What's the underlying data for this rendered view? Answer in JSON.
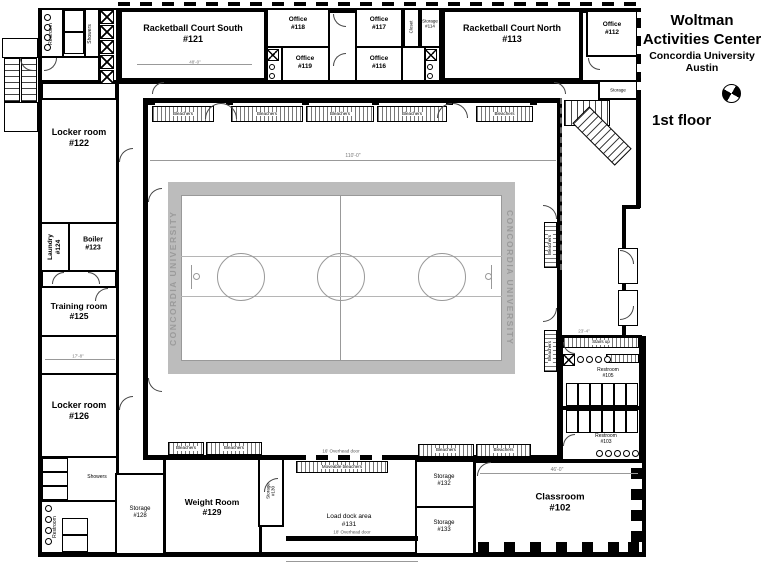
{
  "header": {
    "line1": "Woltman",
    "line2": "Activities Center",
    "line3": "Concordia University",
    "line4": "Austin",
    "floor": "1st floor"
  },
  "plan": {
    "walls": [
      [
        38,
        8,
        5,
        549
      ],
      [
        118,
        8,
        522,
        5
      ],
      [
        38,
        552,
        608,
        5
      ],
      [
        636,
        8,
        5,
        200
      ],
      [
        622,
        205,
        18,
        4
      ],
      [
        622,
        205,
        4,
        135
      ],
      [
        622,
        336,
        24,
        4
      ],
      [
        641,
        340,
        5,
        215
      ],
      [
        40,
        80,
        598,
        4
      ],
      [
        115,
        80,
        4,
        477
      ]
    ],
    "iwalls": [
      [
        62,
        8,
        2,
        50
      ],
      [
        84,
        8,
        2,
        50
      ],
      [
        98,
        8,
        2,
        74
      ],
      [
        40,
        56,
        60,
        2
      ],
      [
        560,
        406,
        82,
        4
      ],
      [
        286,
        536,
        132,
        5
      ]
    ],
    "rooms": [
      {
        "n": "entrance-canopy",
        "x": 2,
        "y": 38,
        "w": 36,
        "h": 20,
        "t": 1
      },
      {
        "n": "entry-landing",
        "x": 4,
        "y": 102,
        "w": 34,
        "h": 30,
        "t": 1
      },
      {
        "n": "utility-block-nw",
        "x": 40,
        "y": 8,
        "w": 78,
        "h": 74,
        "t": 2
      },
      {
        "n": "racketball-court-south-121",
        "x": 118,
        "y": 8,
        "w": 150,
        "h": 74,
        "t": 4
      },
      {
        "n": "office-118",
        "x": 266,
        "y": 8,
        "w": 64,
        "h": 40,
        "t": 2
      },
      {
        "n": "restroom-off-119",
        "x": 266,
        "y": 46,
        "w": 17,
        "h": 36,
        "t": 2
      },
      {
        "n": "office-119",
        "x": 281,
        "y": 46,
        "w": 49,
        "h": 36,
        "t": 2
      },
      {
        "n": "office-117",
        "x": 355,
        "y": 8,
        "w": 48,
        "h": 40,
        "t": 2
      },
      {
        "n": "office-116",
        "x": 355,
        "y": 46,
        "w": 48,
        "h": 36,
        "t": 2
      },
      {
        "n": "closet",
        "x": 403,
        "y": 8,
        "w": 17,
        "h": 40,
        "t": 2
      },
      {
        "n": "storage-114",
        "x": 420,
        "y": 8,
        "w": 21,
        "h": 40,
        "t": 2
      },
      {
        "n": "janitor-closet",
        "x": 424,
        "y": 46,
        "w": 17,
        "h": 36,
        "t": 2
      },
      {
        "n": "racketball-court-north-113",
        "x": 441,
        "y": 8,
        "w": 142,
        "h": 74,
        "t": 4
      },
      {
        "n": "office-112",
        "x": 586,
        "y": 10,
        "w": 52,
        "h": 47,
        "t": 2
      },
      {
        "n": "storage-ne",
        "x": 598,
        "y": 80,
        "w": 40,
        "h": 20,
        "t": 2
      },
      {
        "n": "locker-room-122",
        "x": 40,
        "y": 98,
        "w": 78,
        "h": 126,
        "t": 2
      },
      {
        "n": "laundry-124",
        "x": 40,
        "y": 222,
        "w": 30,
        "h": 50,
        "t": 2
      },
      {
        "n": "boiler-123",
        "x": 68,
        "y": 222,
        "w": 50,
        "h": 50,
        "t": 2
      },
      {
        "n": "training-room-125",
        "x": 40,
        "y": 286,
        "w": 78,
        "h": 51,
        "t": 2
      },
      {
        "n": "room-sw",
        "x": 40,
        "y": 335,
        "w": 78,
        "h": 40,
        "t": 2
      },
      {
        "n": "locker-room-126",
        "x": 40,
        "y": 373,
        "w": 78,
        "h": 85,
        "t": 2
      },
      {
        "n": "showers-sw",
        "x": 40,
        "y": 456,
        "w": 78,
        "h": 46,
        "t": 2
      },
      {
        "n": "restroom-sw",
        "x": 40,
        "y": 500,
        "w": 78,
        "h": 54,
        "t": 2
      },
      {
        "n": "storage-128",
        "x": 115,
        "y": 473,
        "w": 50,
        "h": 82,
        "t": 2
      },
      {
        "n": "weight-room-129",
        "x": 163,
        "y": 455,
        "w": 99,
        "h": 100,
        "t": 3
      },
      {
        "n": "storage-130",
        "x": 258,
        "y": 455,
        "w": 26,
        "h": 72,
        "t": 2
      },
      {
        "n": "storage-132",
        "x": 415,
        "y": 460,
        "w": 60,
        "h": 48,
        "t": 2
      },
      {
        "n": "storage-133",
        "x": 415,
        "y": 506,
        "w": 60,
        "h": 49,
        "t": 2
      },
      {
        "n": "classroom-102",
        "x": 473,
        "y": 460,
        "w": 172,
        "h": 95,
        "t": 3
      },
      {
        "n": "restroom-block-e",
        "x": 560,
        "y": 335,
        "w": 82,
        "h": 127,
        "t": 3
      },
      {
        "n": "entry-alcove-1",
        "x": 618,
        "y": 248,
        "w": 20,
        "h": 36,
        "t": 1
      },
      {
        "n": "entry-alcove-2",
        "x": 618,
        "y": 290,
        "w": 20,
        "h": 36,
        "t": 1
      },
      {
        "n": "gymnasium",
        "x": 143,
        "y": 98,
        "w": 419,
        "h": 362,
        "t": 5
      }
    ],
    "dashes": [
      [
        118,
        2,
        522,
        4,
        "h"
      ],
      [
        637,
        12,
        4,
        88,
        "v"
      ],
      [
        294,
        455,
        96,
        5,
        "h"
      ]
    ],
    "dots": [
      [
        560,
        98,
        2,
        172
      ]
    ],
    "hatches": [
      {
        "x": 152,
        "y": 106,
        "w": 62,
        "h": 16,
        "label": "Bleachers"
      },
      {
        "x": 231,
        "y": 106,
        "w": 72,
        "h": 16,
        "label": "Bleachers"
      },
      {
        "x": 306,
        "y": 106,
        "w": 68,
        "h": 16,
        "label": "Bleachers"
      },
      {
        "x": 377,
        "y": 106,
        "w": 70,
        "h": 16,
        "label": "Bleachers"
      },
      {
        "x": 476,
        "y": 106,
        "w": 57,
        "h": 16,
        "label": "Bleachers"
      },
      {
        "x": 168,
        "y": 442,
        "w": 36,
        "h": 13,
        "label": "Bleachers"
      },
      {
        "x": 206,
        "y": 442,
        "w": 56,
        "h": 13,
        "label": "Bleachers"
      },
      {
        "x": 418,
        "y": 444,
        "w": 56,
        "h": 13,
        "label": "Bleachers"
      },
      {
        "x": 476,
        "y": 444,
        "w": 55,
        "h": 13,
        "label": "Bleachers"
      },
      {
        "x": 544,
        "y": 222,
        "w": 13,
        "h": 46,
        "v": 1,
        "label": "Bleachers"
      },
      {
        "x": 544,
        "y": 330,
        "w": 13,
        "h": 42,
        "v": 1,
        "label": "Bleachers"
      },
      {
        "x": 296,
        "y": 461,
        "w": 92,
        "h": 12,
        "label": "Moveable bleachers"
      },
      {
        "x": 563,
        "y": 337,
        "w": 76,
        "h": 11,
        "label": "Stairs up"
      },
      {
        "x": 606,
        "y": 354,
        "w": 33,
        "h": 9
      }
    ],
    "stairs": [
      {
        "x": 4,
        "y": 58,
        "w": 16,
        "h": 44,
        "d": "v"
      },
      {
        "x": 21,
        "y": 58,
        "w": 16,
        "h": 44,
        "d": "v"
      },
      {
        "x": 564,
        "y": 100,
        "w": 46,
        "h": 26,
        "d": "h"
      },
      {
        "x": 572,
        "y": 124,
        "w": 60,
        "h": 24,
        "d": "h",
        "rot": 45
      }
    ],
    "court": {
      "frame": [
        168,
        182,
        347,
        192
      ],
      "inner": [
        181,
        195,
        321,
        166
      ],
      "center_x": 340,
      "lane_y": [
        256,
        296
      ],
      "circles_cx": [
        241,
        341,
        442
      ],
      "circle_cy": 277,
      "circle_r": 24,
      "brand": "CONCORDIA UNIVERSITY",
      "baskets": [
        {
          "line": [
            191,
            265,
            1,
            24
          ],
          "circ": [
            193,
            273,
            7
          ]
        },
        {
          "line": [
            491,
            265,
            1,
            24
          ],
          "circ": [
            485,
            273,
            7
          ]
        }
      ]
    },
    "cellrows": [
      {
        "x": 64,
        "y": 10,
        "w": 20,
        "h": 44,
        "n": 2,
        "d": "v"
      },
      {
        "x": 42,
        "y": 458,
        "w": 26,
        "h": 42,
        "n": 3,
        "d": "v"
      },
      {
        "x": 62,
        "y": 518,
        "w": 26,
        "h": 34,
        "n": 2,
        "d": "v"
      },
      {
        "x": 566,
        "y": 383,
        "w": 72,
        "h": 23,
        "n": 6,
        "d": "h"
      },
      {
        "x": 566,
        "y": 410,
        "w": 72,
        "h": 23,
        "n": 6,
        "d": "h"
      }
    ],
    "xboxes": [
      [
        100,
        10,
        14
      ],
      [
        100,
        25,
        14
      ],
      [
        100,
        40,
        14
      ],
      [
        100,
        55,
        14
      ],
      [
        100,
        70,
        14
      ],
      [
        267,
        49,
        12
      ],
      [
        425,
        49,
        12
      ],
      [
        563,
        354,
        12
      ]
    ],
    "sinks": [
      {
        "x": 44,
        "y": 14,
        "n": 4,
        "sx": 0,
        "sy": 10,
        "d": 7
      },
      {
        "x": 45,
        "y": 505,
        "n": 4,
        "sx": 0,
        "sy": 11,
        "d": 7
      },
      {
        "x": 577,
        "y": 356,
        "n": 4,
        "sx": 9,
        "sy": 0,
        "d": 7
      },
      {
        "x": 596,
        "y": 450,
        "n": 5,
        "sx": 9,
        "sy": 0,
        "d": 7
      },
      {
        "x": 269,
        "y": 64,
        "n": 2,
        "sx": 0,
        "sy": 9,
        "d": 6
      },
      {
        "x": 427,
        "y": 64,
        "n": 2,
        "sx": 0,
        "sy": 9,
        "d": 6
      }
    ],
    "squares": [
      [
        148,
        98,
        7
      ],
      [
        226,
        98,
        7
      ],
      [
        302,
        98,
        7
      ],
      [
        372,
        98,
        7
      ],
      [
        446,
        98,
        7
      ],
      [
        530,
        98,
        7
      ],
      [
        478,
        542,
        11
      ],
      [
        504,
        542,
        11
      ],
      [
        530,
        542,
        11
      ],
      [
        556,
        542,
        11
      ],
      [
        582,
        542,
        11
      ],
      [
        608,
        542,
        11
      ],
      [
        628,
        542,
        11
      ],
      [
        631,
        468,
        11
      ],
      [
        631,
        489,
        11
      ],
      [
        631,
        510,
        11
      ],
      [
        631,
        531,
        11
      ]
    ],
    "dims": [
      [
        150,
        160,
        406
      ],
      [
        480,
        473,
        158
      ],
      [
        45,
        359,
        70
      ],
      [
        137,
        64,
        115
      ],
      [
        286,
        561,
        132
      ]
    ],
    "doors": [
      [
        205,
        103,
        16,
        "tl"
      ],
      [
        221,
        103,
        16,
        "tr"
      ],
      [
        437,
        103,
        15,
        "tl"
      ],
      [
        453,
        103,
        15,
        "tr"
      ],
      [
        148,
        188,
        14,
        "tl"
      ],
      [
        148,
        378,
        14,
        "bl"
      ],
      [
        543,
        205,
        14,
        "tr"
      ],
      [
        543,
        308,
        14,
        "br"
      ],
      [
        333,
        14,
        13,
        "bl"
      ],
      [
        333,
        53,
        13,
        "tl"
      ],
      [
        52,
        272,
        12,
        "tl"
      ],
      [
        88,
        272,
        12,
        "tr"
      ],
      [
        95,
        288,
        13,
        "tl"
      ],
      [
        119,
        148,
        14,
        "tl"
      ],
      [
        119,
        396,
        14,
        "tl"
      ],
      [
        264,
        478,
        14,
        "tl"
      ],
      [
        477,
        462,
        14,
        "tl"
      ],
      [
        563,
        342,
        12,
        "bl"
      ],
      [
        563,
        434,
        12,
        "tl"
      ],
      [
        620,
        250,
        14,
        "tr"
      ],
      [
        620,
        306,
        14,
        "br"
      ],
      [
        588,
        58,
        12,
        "bl"
      ],
      [
        152,
        82,
        12,
        "tl"
      ],
      [
        554,
        82,
        12,
        "tr"
      ],
      [
        44,
        58,
        13,
        "br"
      ],
      [
        20,
        58,
        13,
        "bl"
      ]
    ],
    "labels": [
      {
        "t": "Racketball Court South\n#121",
        "x": 193,
        "y": 34,
        "s": 9,
        "b": 1
      },
      {
        "t": "Office\n#118",
        "x": 298,
        "y": 24,
        "s": 6.5,
        "b": 1
      },
      {
        "t": "Office\n#119",
        "x": 305,
        "y": 63,
        "s": 6.5,
        "b": 1
      },
      {
        "t": "Office\n#117",
        "x": 379,
        "y": 24,
        "s": 6.5,
        "b": 1
      },
      {
        "t": "Office\n#116",
        "x": 379,
        "y": 63,
        "s": 6.5,
        "b": 1
      },
      {
        "t": "Closet",
        "x": 411,
        "y": 27,
        "s": 4.5,
        "r": -90
      },
      {
        "t": "Storage\n#114",
        "x": 430,
        "y": 24,
        "s": 4.5
      },
      {
        "t": "Racketball Court North\n#113",
        "x": 512,
        "y": 34,
        "s": 9,
        "b": 1
      },
      {
        "t": "Office\n#112",
        "x": 612,
        "y": 29,
        "s": 6.5,
        "b": 1
      },
      {
        "t": "Storage",
        "x": 618,
        "y": 90,
        "s": 4.5
      },
      {
        "t": "Locker room\n#122",
        "x": 79,
        "y": 138,
        "s": 9,
        "b": 1
      },
      {
        "t": "Laundry\n#124",
        "x": 55,
        "y": 247,
        "s": 6.5,
        "b": 1,
        "r": -90
      },
      {
        "t": "Boiler\n#123",
        "x": 93,
        "y": 245,
        "s": 7,
        "b": 1
      },
      {
        "t": "Training room\n#125",
        "x": 79,
        "y": 311,
        "s": 8.5,
        "b": 1
      },
      {
        "t": "Locker room\n#126",
        "x": 79,
        "y": 411,
        "s": 9,
        "b": 1
      },
      {
        "t": "Showers",
        "x": 97,
        "y": 477,
        "s": 5
      },
      {
        "t": "Restroom",
        "x": 55,
        "y": 527,
        "s": 5,
        "r": -90
      },
      {
        "t": "Restroom",
        "x": 51,
        "y": 34,
        "s": 5,
        "r": -90
      },
      {
        "t": "Showers",
        "x": 90,
        "y": 34,
        "s": 5,
        "r": -90
      },
      {
        "t": "Storage\n#128",
        "x": 140,
        "y": 513,
        "s": 6
      },
      {
        "t": "Weight Room\n#129",
        "x": 212,
        "y": 507,
        "s": 8.5,
        "b": 1
      },
      {
        "t": "Storage\n#130",
        "x": 271,
        "y": 491,
        "s": 4.5,
        "r": -90
      },
      {
        "t": "16' Overhead door",
        "x": 341,
        "y": 451,
        "s": 4.5,
        "c": "#555"
      },
      {
        "t": "Load dock area\n#131",
        "x": 349,
        "y": 521,
        "s": 6.5
      },
      {
        "t": "18' Overhead door",
        "x": 352,
        "y": 532,
        "s": 4.5,
        "c": "#555"
      },
      {
        "t": "Storage\n#132",
        "x": 444,
        "y": 481,
        "s": 6
      },
      {
        "t": "Storage\n#133",
        "x": 444,
        "y": 527,
        "s": 6
      },
      {
        "t": "Classroom\n#102",
        "x": 560,
        "y": 503,
        "s": 9.5,
        "b": 1
      },
      {
        "t": "Restroom\n#105",
        "x": 608,
        "y": 373,
        "s": 5
      },
      {
        "t": "Restroom\n#103",
        "x": 606,
        "y": 439,
        "s": 5
      },
      {
        "t": "110'-0\"",
        "x": 353,
        "y": 156,
        "s": 5,
        "c": "#777"
      },
      {
        "t": "48'-0\"",
        "x": 195,
        "y": 62,
        "s": 4.5,
        "c": "#777"
      },
      {
        "t": "46'-0\"",
        "x": 557,
        "y": 470,
        "s": 5,
        "c": "#777"
      },
      {
        "t": "17'-8\"",
        "x": 78,
        "y": 356,
        "s": 4.5,
        "c": "#777"
      },
      {
        "t": "23'-4\"",
        "x": 584,
        "y": 331,
        "s": 4.5,
        "c": "#777"
      }
    ]
  }
}
